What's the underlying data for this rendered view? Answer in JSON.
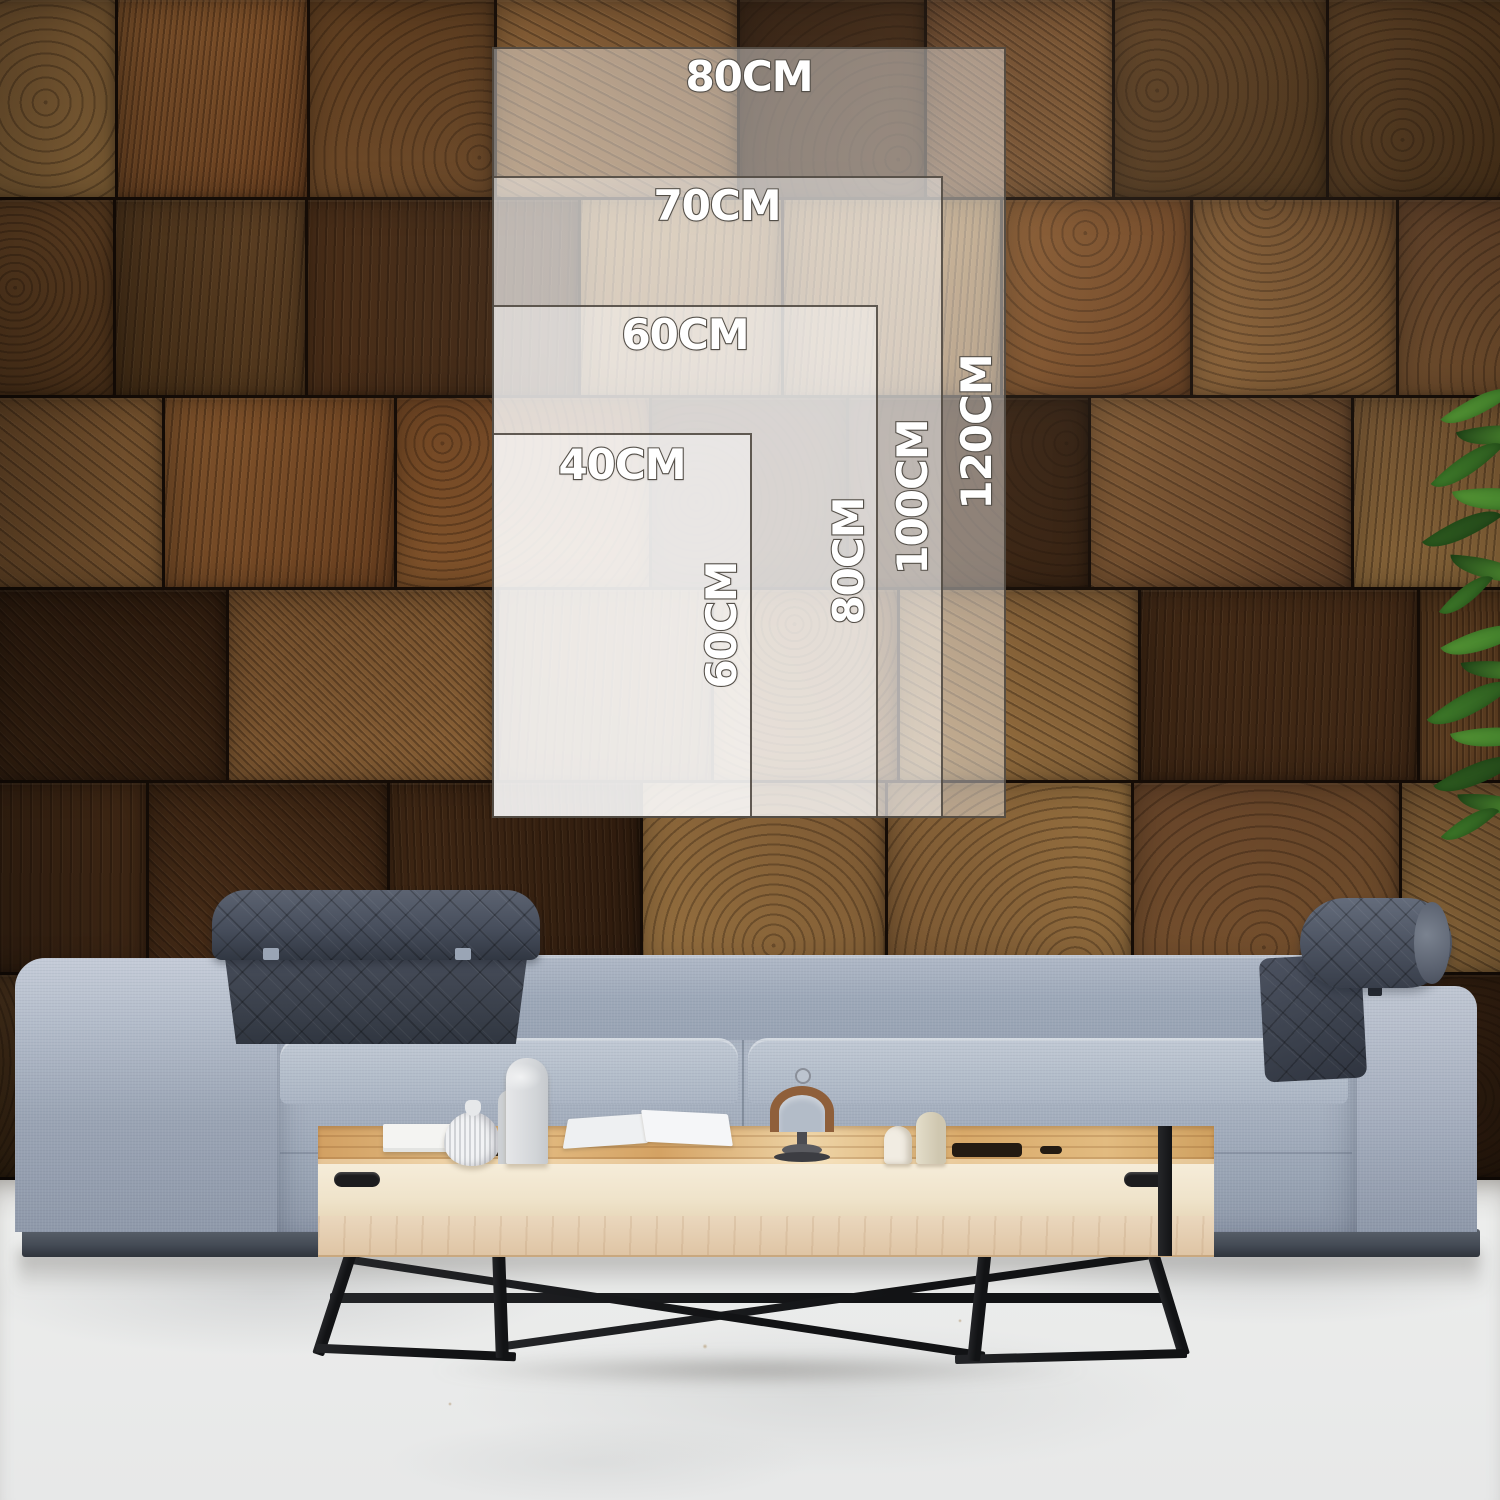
{
  "size_guide": {
    "title": "Wall art size comparison overlay",
    "unit": "CM",
    "sizes": [
      {
        "id": "80x120",
        "width_cm": 80,
        "height_cm": 120,
        "width_label": "80CM",
        "height_label": "120CM"
      },
      {
        "id": "70x100",
        "width_cm": 70,
        "height_cm": 100,
        "width_label": "70CM",
        "height_label": "100CM"
      },
      {
        "id": "60x80",
        "width_cm": 60,
        "height_cm": 80,
        "width_label": "60CM",
        "height_label": "80CM"
      },
      {
        "id": "40x60",
        "width_cm": 40,
        "height_cm": 60,
        "width_label": "40CM",
        "height_label": "60CM"
      }
    ]
  },
  "colors": {
    "overlay_fill": "#FFFFFF",
    "overlay_border": "#463F37",
    "label_text": "#FFFFFF",
    "label_outline": "#58534C",
    "wall_wood_dark": "#3C2513",
    "wall_wood_light": "#96703F",
    "sofa_fabric": "#A3ADBD",
    "headrest_fabric": "#3D434E",
    "table_wood": "#E0B478",
    "table_face": "#F3E9D4",
    "metal_legs": "#17181A",
    "floor": "#E8E9E9",
    "plant_green": "#3F7C2A"
  }
}
